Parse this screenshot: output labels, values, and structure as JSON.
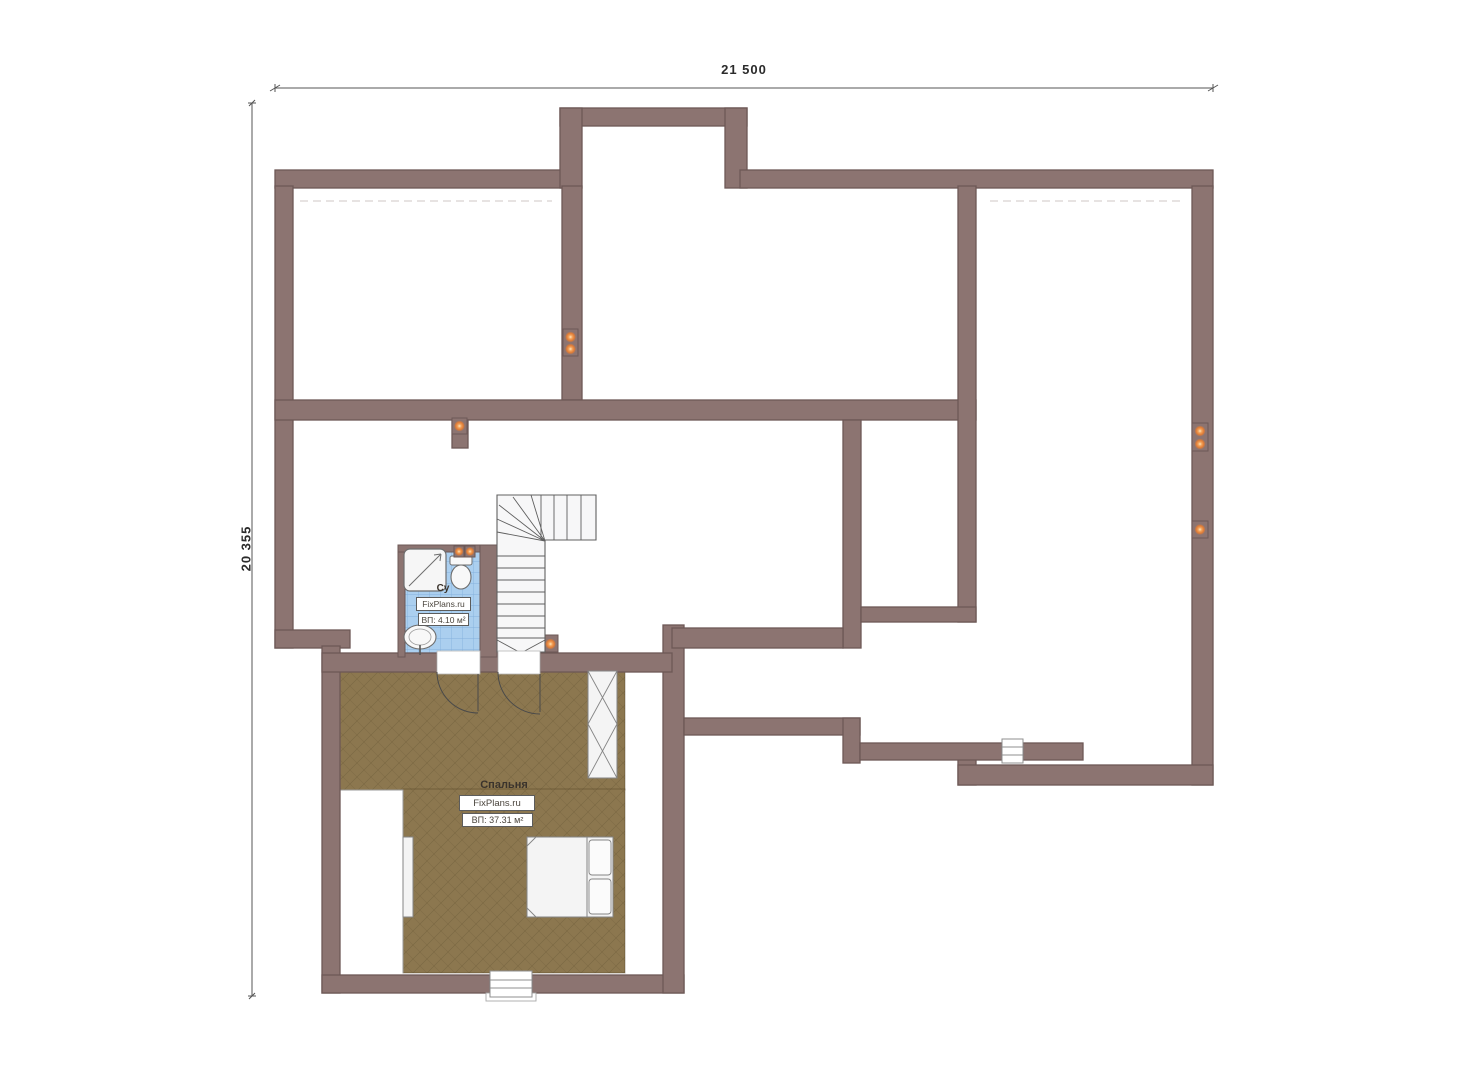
{
  "plan": {
    "type": "floor-plan",
    "dimensions": {
      "top": "21 500",
      "left": "20 355"
    },
    "rooms": {
      "bedroom": {
        "name": "Спальня",
        "watermark": "FixPlans.ru",
        "area": "ВП: 37.31 м²"
      },
      "bathroom": {
        "name": "Су",
        "watermark": "FixPlans.ru",
        "area": "ВП: 4.10 м²"
      }
    },
    "fixtures": [
      "stairs",
      "shower",
      "toilet",
      "sink",
      "bed",
      "wardrobe",
      "dresser",
      "window",
      "door",
      "power-socket"
    ],
    "socket_count": 9,
    "colors": {
      "wall_fill": "#8C7471",
      "wall_edge": "#6D5856",
      "floor": "#8C774F",
      "tile_fill": "#ABCFEF",
      "tile_grid": "#84B1DE",
      "socket": "#DE7B36",
      "socket_glow": "#FFE7BC",
      "furniture_fill": "#F4F4F4",
      "stair_line": "#5F5F5F",
      "dimension_line": "#555555"
    }
  }
}
